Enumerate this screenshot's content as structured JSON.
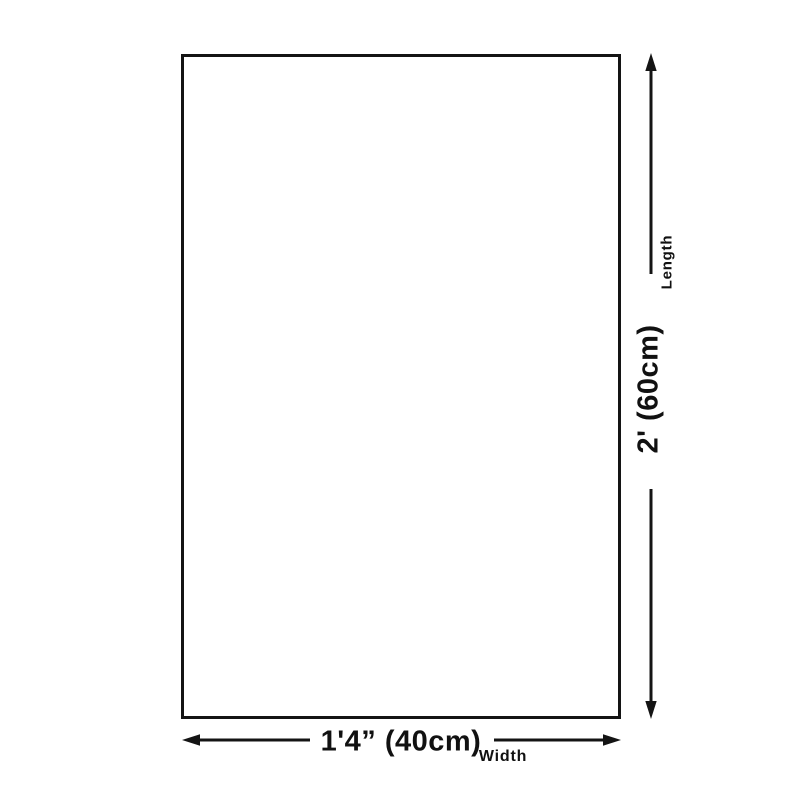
{
  "diagram": {
    "shape": "rectangle-outline",
    "background_color": "#ffffff",
    "line_color": "#141414",
    "text_color": "#111111",
    "vertical_dimension": {
      "axis_label": "Length",
      "value_label": "2' (60cm)"
    },
    "horizontal_dimension": {
      "axis_label": "Width",
      "value_label": "1'4” (40cm)"
    }
  }
}
